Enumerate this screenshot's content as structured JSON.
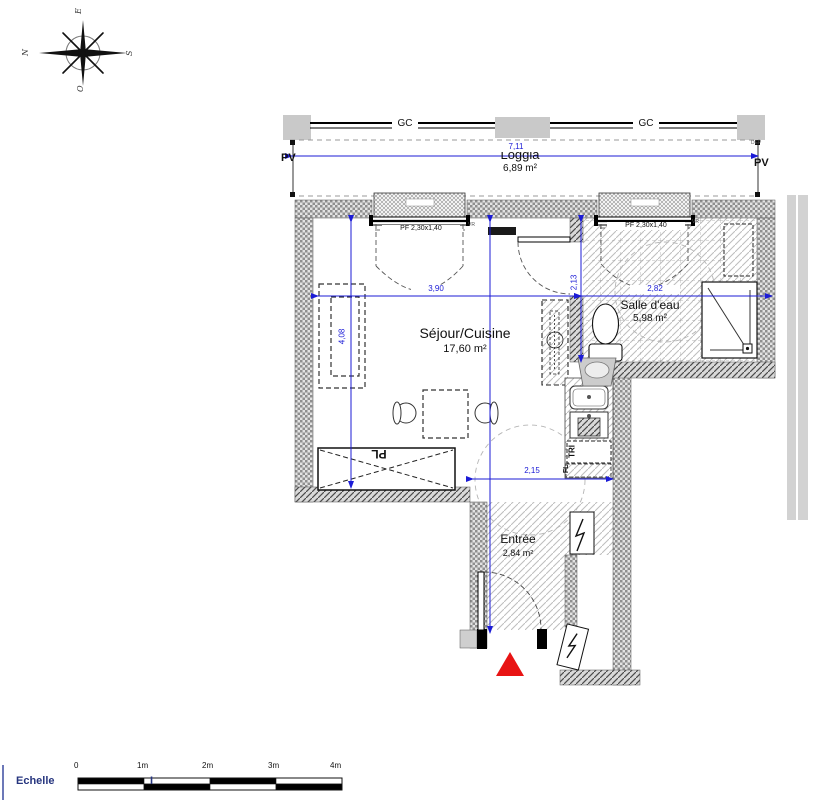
{
  "meta": {
    "drawing_type": "apartment floor plan"
  },
  "compass": {
    "n": "N",
    "e": "E",
    "s": "S",
    "o": "O"
  },
  "loggia": {
    "name": "Loggia",
    "area": "6,89 m²",
    "dim_width": "7,11",
    "rail_label": "GC",
    "post_label": "PV",
    "dep_label": "DEP"
  },
  "windows": {
    "label": "PF 2,30x1,40",
    "shutter_label": "VR"
  },
  "sejour": {
    "name": "Séjour/Cuisine",
    "area": "17,60 m²",
    "dim_width": "3,90",
    "dim_height": "4,08",
    "closet_label": "PL"
  },
  "kitchen": {
    "tri_label": "TRI",
    "fl_label": "FL",
    "dim_width": "2,15"
  },
  "salle_eau": {
    "name": "Salle d'eau",
    "area": "5,98 m²",
    "dim_width": "2,82",
    "dim_height": "2,13"
  },
  "entree": {
    "name": "Entrée",
    "area": "2,84 m²"
  },
  "scale_bar": {
    "label": "Echelle",
    "separator": "I",
    "ticks": [
      "0",
      "1m",
      "2m",
      "3m",
      "4m"
    ]
  },
  "colors": {
    "dimension_blue": "#1b1bd6",
    "entrance_red": "#e81414",
    "scale_navy": "#27367f"
  }
}
